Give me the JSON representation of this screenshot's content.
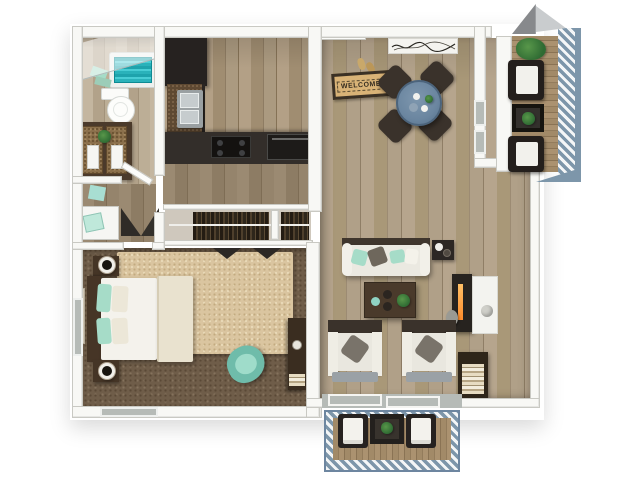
{
  "labels": {
    "welcome_mat": "WELCOME"
  },
  "colors": {
    "wall": "#f8f8f5",
    "wall_edge": "#c9c9c3",
    "glass": "#b6bbb7",
    "carpet": "#6f5d49",
    "rug": "#dac5a0",
    "counter": "#332e2a",
    "cabinet": "#262220",
    "furniture_dark": "#3a322b",
    "cushion": "#ebe9e1",
    "mint": "#a6dcc8",
    "teal_water": "#2ab2ba",
    "dining_table_blue": "#6b86a0",
    "rail_blue": "#7d96aa",
    "flame_orange": "#ff8c2b",
    "mat": "#d9b377",
    "mat_text": "#342c20",
    "plant_green": "#3f7a3a",
    "wood_floor": "#ad9c84",
    "wood_floor_dark": "#9b8a72",
    "wood_floor_light": "#c2b49e"
  }
}
